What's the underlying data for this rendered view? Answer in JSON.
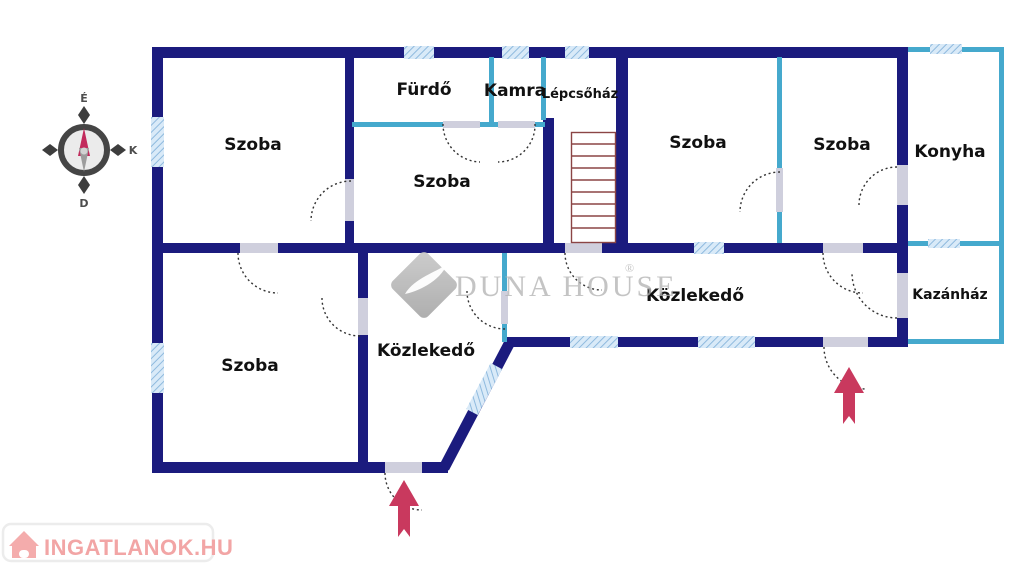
{
  "plan": {
    "type": "floor-plan",
    "rooms": [
      {
        "id": "szoba-top-left",
        "label": "Szoba"
      },
      {
        "id": "furdo",
        "label": "Fürdő"
      },
      {
        "id": "kamra",
        "label": "Kamra"
      },
      {
        "id": "lepcsohaz",
        "label": "Lépcsőház"
      },
      {
        "id": "szoba-middle",
        "label": "Szoba"
      },
      {
        "id": "szoba-north-1",
        "label": "Szoba"
      },
      {
        "id": "szoba-north-2",
        "label": "Szoba"
      },
      {
        "id": "konyha",
        "label": "Konyha"
      },
      {
        "id": "kazanhaz",
        "label": "Kazánház"
      },
      {
        "id": "kozlekedo-right",
        "label": "Közlekedő"
      },
      {
        "id": "kozlekedo-left",
        "label": "Közlekedő"
      },
      {
        "id": "szoba-bottom-left",
        "label": "Szoba"
      }
    ],
    "features": [
      "stairs",
      "entrance-arrow-south",
      "entrance-arrow-east-hall",
      "windows",
      "door-swings"
    ]
  },
  "compass": {
    "north_label": "É",
    "east_label": "K",
    "south_label": "D"
  },
  "watermark": {
    "brand": "Duna House",
    "display": "DUNA HOUSE",
    "registered_mark": "®"
  },
  "site_logo": {
    "text": "INGATLANOK.HU"
  },
  "colors": {
    "wall_main": "#1b1b7e",
    "wall_light": "#45a9cd",
    "window_fill": "#d9eaf8",
    "window_stripe": "#8fbade",
    "opening_gray": "#cfcfdd",
    "stairs": "#8b4545",
    "entrance_arrow": "#c9395e",
    "label_text": "#111111",
    "watermark_gray": "#b2b2b2",
    "logo_pink": "#f2a5a5"
  }
}
